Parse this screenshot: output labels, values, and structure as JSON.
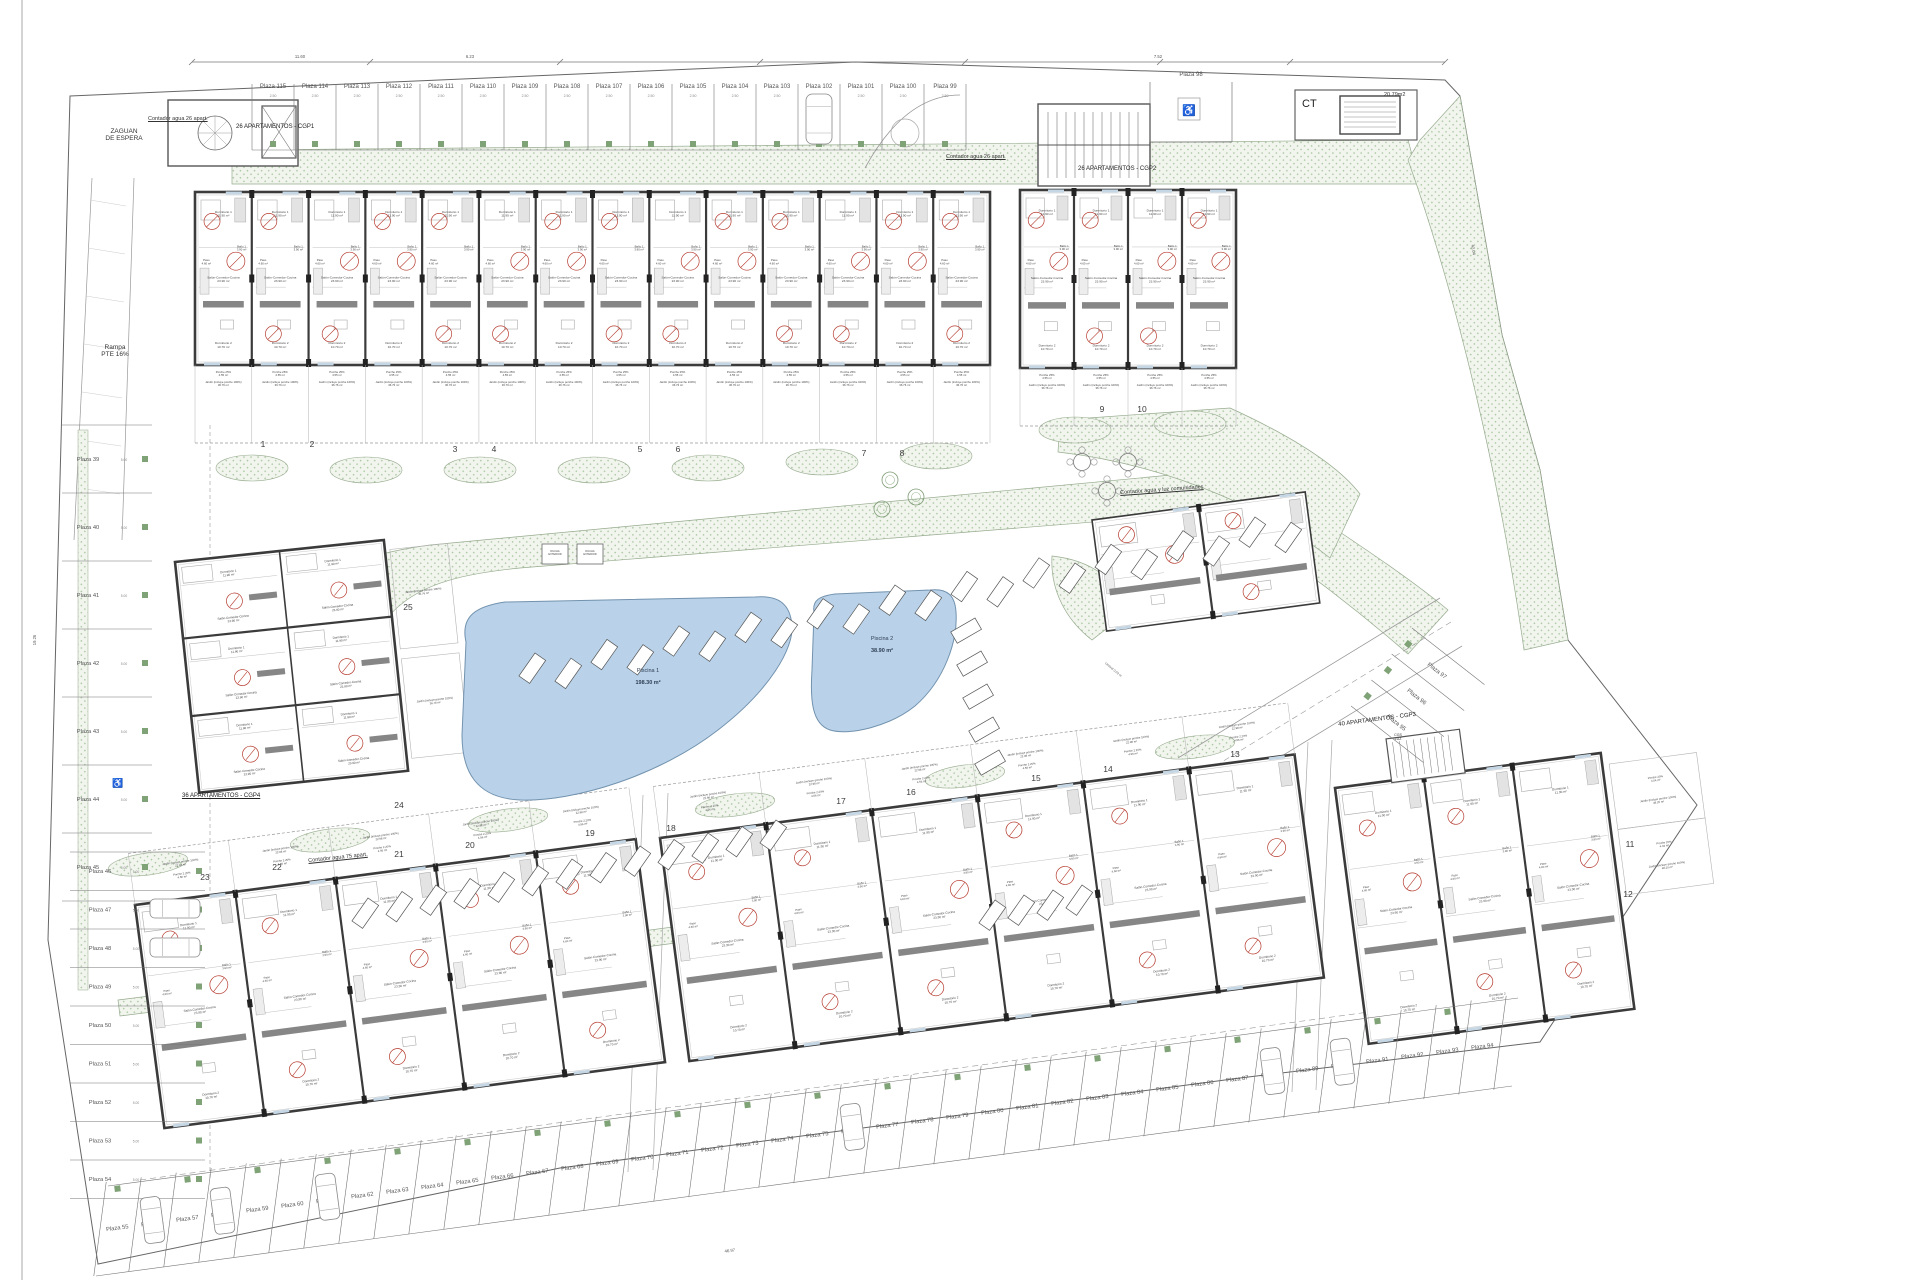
{
  "sheet": {
    "title": "Plano de implantación - conjunto residencial"
  },
  "labels": {
    "zaguan": "ZAGUAN\nDE ESPERA",
    "rampa": "Rampa\nPTE 16%",
    "cgp1": "26 APARTAMENTOS - CGP1",
    "cgp2": "26 APARTAMENTOS - CGP2",
    "cgp3": "40 APARTAMENTOS - CGP3",
    "cgp4": "36 APARTAMENTOS - CGP4",
    "contador26a": "Contador agua 26 apart.",
    "contador26b": "Contador agua 26 apart.",
    "contador75": "Contador agua 75 apart.",
    "contador_com": "Contador agua y luz comunidades",
    "cgs_luz": "CGS\nLUZ",
    "umbral": "Umbral 0.03 m",
    "ducha": [
      "DUCHA",
      "EXTERIOR"
    ]
  },
  "ct": {
    "label": "CT",
    "area": "20.79m2"
  },
  "pools": [
    {
      "name": "Piscina 1",
      "area": "198.30 m²"
    },
    {
      "name": "Piscina 2",
      "area": "38.90 m²"
    }
  ],
  "gardens": [
    "1",
    "2",
    "3",
    "4",
    "5",
    "6",
    "7",
    "8",
    "9",
    "10",
    "11",
    "12",
    "13",
    "14",
    "15",
    "16",
    "17",
    "18",
    "19",
    "20",
    "21",
    "22",
    "23",
    "24",
    "25"
  ],
  "plazas": {
    "top": [
      "Plaza 115",
      "Plaza 114",
      "Plaza 113",
      "Plaza 112",
      "Plaza 111",
      "Plaza 110",
      "Plaza 109",
      "Plaza 108",
      "Plaza 107",
      "Plaza 106",
      "Plaza 105",
      "Plaza 104",
      "Plaza 103",
      "Plaza 102",
      "Plaza 101",
      "Plaza 100",
      "Plaza 99"
    ],
    "top_right": "Plaza 98",
    "left": [
      "Plaza 39",
      "Plaza 40",
      "Plaza 41",
      "Plaza 42",
      "Plaza 43",
      "Plaza 44",
      "Plaza 45",
      "Plaza 46",
      "Plaza 47",
      "Plaza 48",
      "Plaza 49",
      "Plaza 50",
      "Plaza 51",
      "Plaza 52",
      "Plaza 53",
      "Plaza 54"
    ],
    "bottom": [
      "Plaza 55",
      "Plaza 56",
      "Plaza 57",
      "Plaza 58",
      "Plaza 59",
      "Plaza 60",
      "Plaza 61",
      "Plaza 62",
      "Plaza 63",
      "Plaza 64",
      "Plaza 65",
      "Plaza 66",
      "Plaza 67",
      "Plaza 68",
      "Plaza 69",
      "Plaza 70",
      "Plaza 71",
      "Plaza 72",
      "Plaza 73",
      "Plaza 74",
      "Plaza 75",
      "Plaza 76",
      "Plaza 77",
      "Plaza 78",
      "Plaza 79",
      "Plaza 80",
      "Plaza 81",
      "Plaza 82",
      "Plaza 83",
      "Plaza 84",
      "Plaza 85",
      "Plaza 86",
      "Plaza 87",
      "Plaza 88",
      "Plaza 89",
      "Plaza 90",
      "Plaza 91",
      "Plaza 92",
      "Plaza 93",
      "Plaza 94"
    ],
    "diag": [
      "Plaza 97",
      "Plaza 96",
      "Plaza 95"
    ]
  },
  "rooms": {
    "dorm1": [
      "Dormitorio 1",
      "11.90 m²"
    ],
    "dorm2": [
      "Dormitorio 2",
      "10.70 m²"
    ],
    "dorm3": [
      "Dormitorio 3",
      "8.90 m²"
    ],
    "salon": [
      "Salón-Comedor-Cocina",
      "23.90 m²"
    ],
    "bano1": [
      "Baño 1",
      "3.90 m²"
    ],
    "bano2": [
      "Baño 2",
      "3.90 m²"
    ],
    "paso": [
      "Paso",
      "4.60 m²"
    ]
  },
  "porch": {
    "porche_top": [
      "Porche 25%",
      "4.55 m²"
    ],
    "jardin_top": [
      "Jardín (incluye porche 100%)",
      "36.76 m²"
    ],
    "porche_bottom": [
      "Porche 2.20%",
      "4.56 m²"
    ],
    "jardin_bottom": [
      "Jardín (incluye porche 100%)",
      "22.98 m²"
    ],
    "porche_right": [
      "Porche 20%",
      "4.04 m²"
    ],
    "jardin_right": [
      "Jardín (incluye porche 100%)",
      "48.20 m²"
    ]
  },
  "dims": {
    "d_top1": "11.60",
    "d_top2": "6.23",
    "d_top3": "7.52",
    "d_right": "42.04",
    "d_left": "19.26",
    "d_bottom": "46.97",
    "stall_w": "2.50",
    "stall_d": "5.00"
  },
  "icons": {
    "wheelchair": "♿"
  },
  "colors": {
    "wall": "#3b3b3b",
    "hair": "#9a9a9a",
    "green_dot": "#a9c5a0",
    "green_sq": "#7fa276",
    "pool_fill": "#b9d2e9",
    "pool_edge": "#7292ae",
    "door_red": "#b53a2e",
    "terrace": "#868686"
  }
}
